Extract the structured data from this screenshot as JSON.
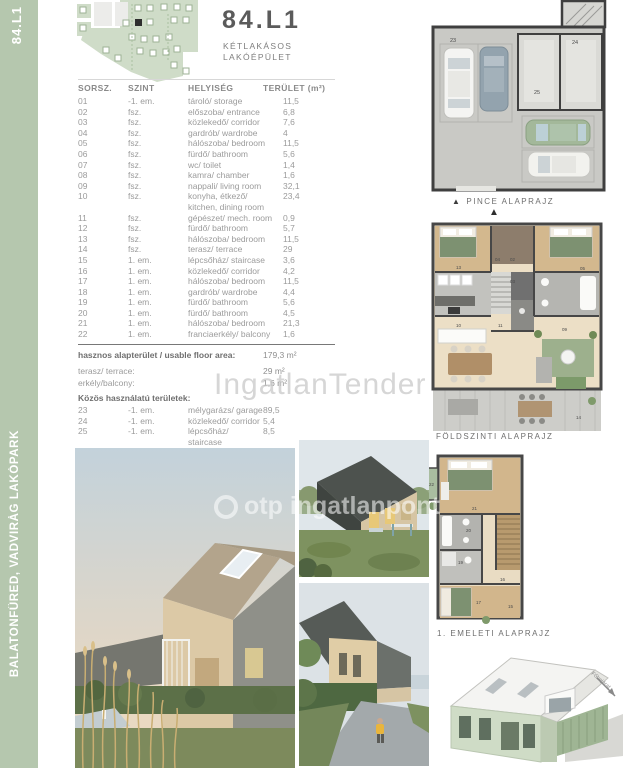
{
  "sidebar": {
    "unit_top": "84.L1",
    "project": "BALATONFÜRED, VADVIRÁG LAKÓPARK",
    "color": "#b5c7ae"
  },
  "header": {
    "title": "84.L1",
    "subtitle_line1": "KÉTLAKÁSOS",
    "subtitle_line2": "LAKÓÉPÜLET"
  },
  "table": {
    "headers": {
      "sorsz": "SORSZ.",
      "szint": "SZINT",
      "helyiseg": "HELYISÉG",
      "terulet": "TERÜLET (m²)"
    },
    "rows": [
      {
        "no": "01",
        "level": "-1. em.",
        "room": "tároló/ storage",
        "area": "11,5"
      },
      {
        "no": "02",
        "level": "fsz.",
        "room": "előszoba/ entrance",
        "area": "6,8"
      },
      {
        "no": "03",
        "level": "fsz.",
        "room": "közlekedő/ corridor",
        "area": "7,6"
      },
      {
        "no": "04",
        "level": "fsz.",
        "room": "gardrób/ wardrobe",
        "area": "4"
      },
      {
        "no": "05",
        "level": "fsz.",
        "room": "hálószoba/ bedroom",
        "area": "11,5"
      },
      {
        "no": "06",
        "level": "fsz.",
        "room": "fürdő/ bathroom",
        "area": "5,6"
      },
      {
        "no": "07",
        "level": "fsz.",
        "room": "wc/ toilet",
        "area": "1,4"
      },
      {
        "no": "08",
        "level": "fsz.",
        "room": "kamra/ chamber",
        "area": "1,6"
      },
      {
        "no": "09",
        "level": "fsz.",
        "room": "nappali/ living room",
        "area": "32,1"
      },
      {
        "no": "10",
        "level": "fsz.",
        "room": "konyha, étkező/",
        "room2": "kitchen, dining room",
        "area": "23,4"
      },
      {
        "no": "11",
        "level": "fsz.",
        "room": "gépészet/ mech. room",
        "area": "0,9"
      },
      {
        "no": "12",
        "level": "fsz.",
        "room": "fürdő/ bathroom",
        "area": "5,7"
      },
      {
        "no": "13",
        "level": "fsz.",
        "room": "hálószoba/ bedroom",
        "area": "11,5"
      },
      {
        "no": "14",
        "level": "fsz.",
        "room": "terasz/ terrace",
        "area": "29"
      },
      {
        "no": "15",
        "level": "1. em.",
        "room": "lépcsőház/ staircase",
        "area": "3,6"
      },
      {
        "no": "16",
        "level": "1. em.",
        "room": "közlekedő/ corridor",
        "area": "4,2"
      },
      {
        "no": "17",
        "level": "1. em.",
        "room": "hálószoba/ bedroom",
        "area": "11,5"
      },
      {
        "no": "18",
        "level": "1. em.",
        "room": "gardrób/ wardrobe",
        "area": "4,4"
      },
      {
        "no": "19",
        "level": "1. em.",
        "room": "fürdő/ bathroom",
        "area": "5,6"
      },
      {
        "no": "20",
        "level": "1. em.",
        "room": "fürdő/ bathroom",
        "area": "4,5"
      },
      {
        "no": "21",
        "level": "1. em.",
        "room": "hálószoba/ bedroom",
        "area": "21,3"
      },
      {
        "no": "22",
        "level": "1. em.",
        "room": "franciaerkély/ balcony",
        "area": "1,6"
      }
    ]
  },
  "summary": {
    "usable_label": "hasznos alapterület / usable floor area:",
    "usable_value": "179,3 m²",
    "terrace_label": "terasz/ terrace:",
    "terrace_value": "29 m²",
    "balcony_label": "erkély/balcony:",
    "balcony_value": "1,6 m²"
  },
  "common": {
    "title": "Közös használatú területek:",
    "rows": [
      {
        "no": "23",
        "level": "-1. em.",
        "room": "mélygarázs/ garage",
        "area": "89,5"
      },
      {
        "no": "24",
        "level": "-1. em.",
        "room": "közlekedő/ corridor",
        "area": "5,4"
      },
      {
        "no": "25",
        "level": "-1. em.",
        "room": "lépcsőház/ staircase",
        "area": "8,5"
      }
    ]
  },
  "plans": {
    "pince_label": "PINCE ALAPRAJZ",
    "foldszint_label": "FÖLDSZINTI ALAPRAJZ",
    "emelet_label": "1. EMELETI ALAPRAJZ",
    "entrance_label": "Főbejárat",
    "pince": {
      "numbers": [
        "23",
        "24",
        "25"
      ]
    },
    "foldszint": {
      "numbers": [
        "02",
        "03",
        "04",
        "05",
        "09",
        "10",
        "11",
        "13",
        "14"
      ]
    },
    "emelet": {
      "numbers": [
        "15",
        "16",
        "17",
        "19",
        "20",
        "21",
        "22"
      ]
    }
  },
  "icons": {
    "north_arrow": "▲"
  },
  "watermarks": {
    "tender": "IngatlanTender",
    "photo": "otp ingatlanpont"
  }
}
